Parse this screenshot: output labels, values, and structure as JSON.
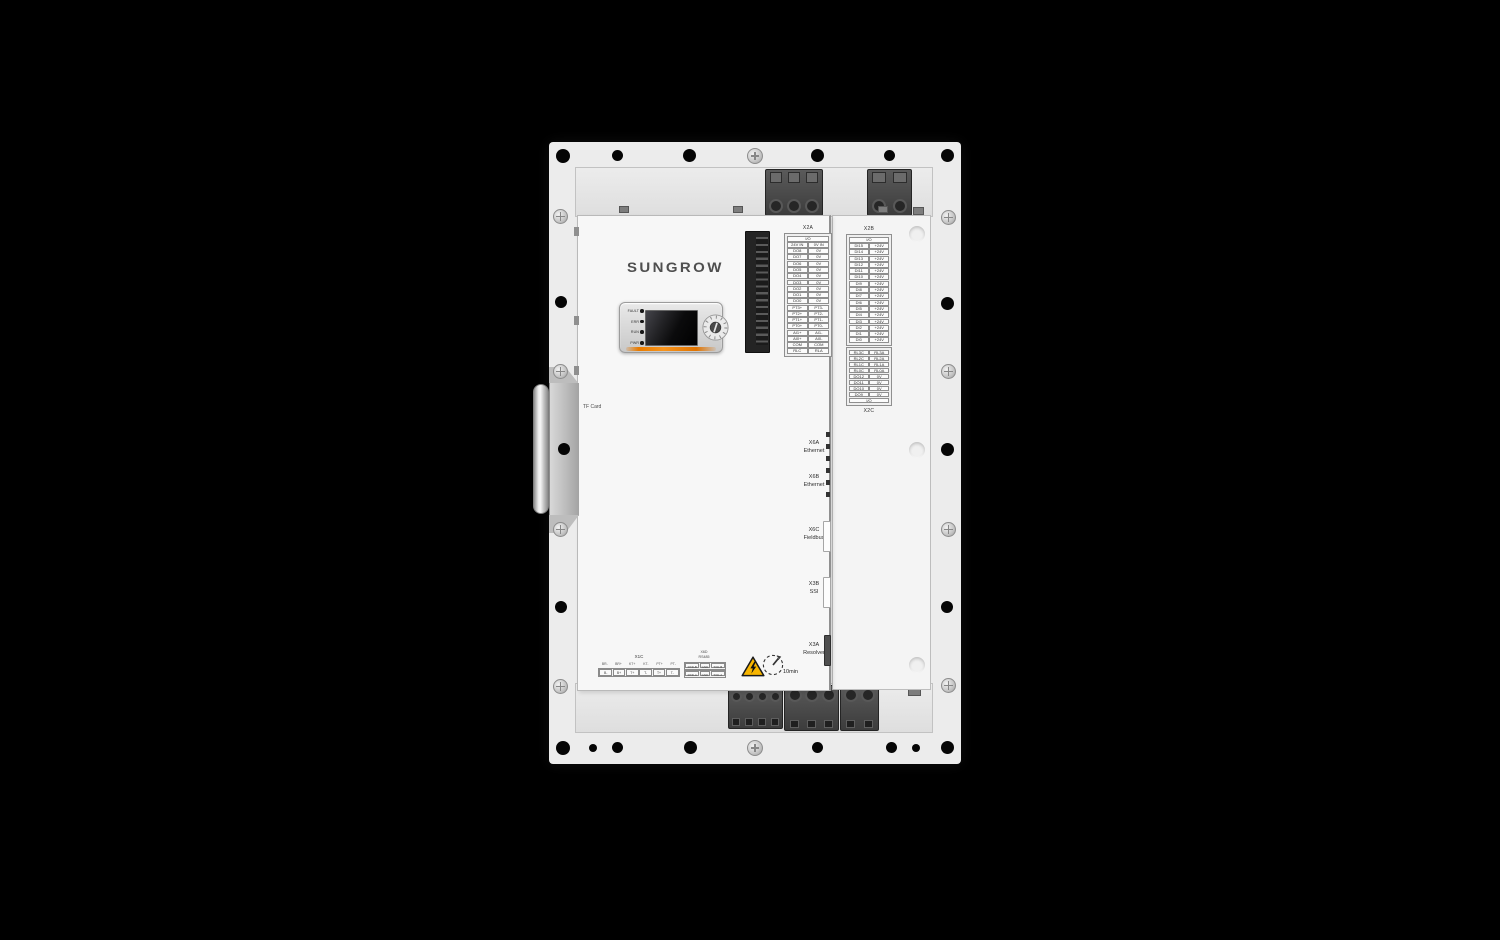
{
  "device": {
    "brand": "SUNGROW",
    "tf_card_label": "TF Card",
    "discharge_time": "10min"
  },
  "status_leds": [
    {
      "label": "FAULT"
    },
    {
      "label": "ERR"
    },
    {
      "label": "RUN"
    },
    {
      "label": "PWR"
    }
  ],
  "terminal_x2a": {
    "label": "X2A",
    "header": "I/O",
    "rows": [
      [
        "24V IN",
        "0V IN"
      ],
      [
        "DO8",
        "0V"
      ],
      [
        "DO7",
        "0V"
      ],
      [
        "DO6",
        "0V"
      ],
      [
        "DO5",
        "0V"
      ],
      [
        "DO4",
        "0V"
      ],
      [
        "DO3",
        "0V"
      ],
      [
        "DO2",
        "0V"
      ],
      [
        "DO1",
        "0V"
      ],
      [
        "DO0",
        "0V"
      ],
      [
        "PT3+",
        "PT3-"
      ],
      [
        "PT2+",
        "PT2-"
      ],
      [
        "PT1+",
        "PT1-"
      ],
      [
        "PT0+",
        "PT0-"
      ],
      [
        "AI1+",
        "AI1-"
      ],
      [
        "AI0+",
        "AI0-"
      ],
      [
        "COM",
        "COM"
      ],
      [
        "RLC",
        "RLA"
      ]
    ]
  },
  "terminal_x2b": {
    "label": "X2B",
    "header": "I/O",
    "rows": [
      [
        "DI15",
        "+24V"
      ],
      [
        "DI14",
        "+24V"
      ],
      [
        "DI13",
        "+24V"
      ],
      [
        "DI12",
        "+24V"
      ],
      [
        "DI11",
        "+24V"
      ],
      [
        "DI10",
        "+24V"
      ],
      [
        "DI9",
        "+24V"
      ],
      [
        "DI8",
        "+24V"
      ],
      [
        "DI7",
        "+24V"
      ],
      [
        "DI6",
        "+24V"
      ],
      [
        "DI5",
        "+24V"
      ],
      [
        "DI4",
        "+24V"
      ],
      [
        "DI3",
        "+24V"
      ],
      [
        "DI2",
        "+24V"
      ],
      [
        "DI1",
        "+24V"
      ],
      [
        "DI0",
        "+24V"
      ]
    ]
  },
  "terminal_x2c": {
    "label": "X2C",
    "footer": "I/O",
    "rows": [
      [
        "RL3C",
        "RL3A"
      ],
      [
        "RL2C",
        "RL2A"
      ],
      [
        "RL1C",
        "RL1A"
      ],
      [
        "RL0C",
        "RL0A"
      ],
      [
        "DO12",
        "0V"
      ],
      [
        "DO11",
        "0V"
      ],
      [
        "DO10",
        "0V"
      ],
      [
        "DO9",
        "0V"
      ]
    ]
  },
  "side_connectors": [
    {
      "id": "X6A",
      "type": "Ethernet"
    },
    {
      "id": "X6B",
      "type": "Ethernet"
    },
    {
      "id": "X6C",
      "type": "Fieldbus"
    },
    {
      "id": "X3B",
      "type": "SSI"
    },
    {
      "id": "X3A",
      "type": "Resolver"
    }
  ],
  "terminal_x1c": {
    "label": "X1C",
    "top_row": [
      "BR-",
      "BR+",
      "KT+",
      "KT-",
      "PT+",
      "PT-"
    ],
    "bottom_row": [
      "B-",
      "B+",
      "T+",
      "T-",
      "T+",
      "T-"
    ]
  },
  "terminal_x6d": {
    "label": "X6D",
    "sublabel": "RS485",
    "rows": [
      [
        "RXD-B",
        "GND",
        "TXD-B"
      ],
      [
        "RXD-A",
        "GND",
        "TXD-A"
      ]
    ]
  },
  "icons": {
    "warning": "high-voltage-warning-icon",
    "clock": "discharge-time-clock-icon",
    "rotary": "rotary-address-switch"
  },
  "colors": {
    "accent_orange": "#f08300",
    "warning_yellow": "#f7b500",
    "panel_white": "#f4f4f4",
    "background": "#000000"
  }
}
